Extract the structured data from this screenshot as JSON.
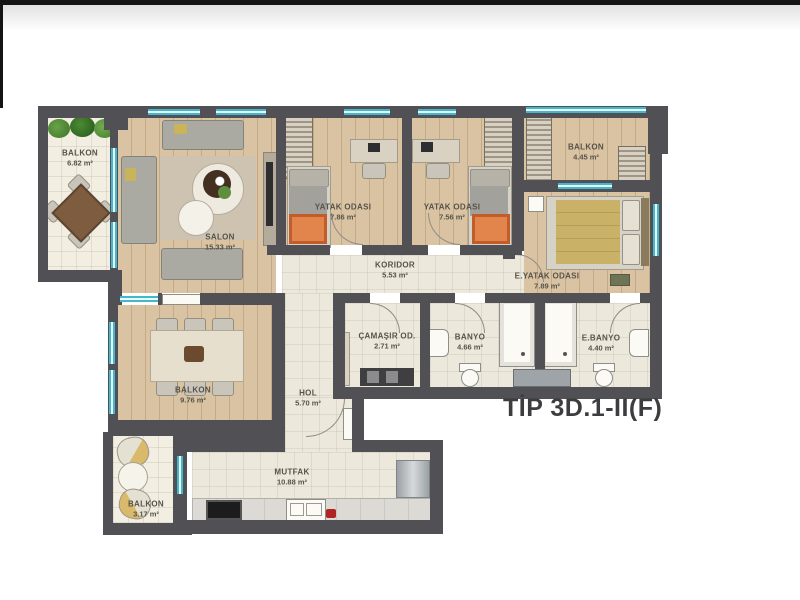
{
  "title": "TİP 3D.1-II(F)",
  "rooms": {
    "balkon_tl": {
      "label": "BALKON",
      "area": "6.82 m²"
    },
    "salon": {
      "label": "SALON",
      "area": "15.33 m²"
    },
    "yatak1": {
      "label": "YATAK ODASI",
      "area": "7.86 m²"
    },
    "yatak2": {
      "label": "YATAK ODASI",
      "area": "7.56 m²"
    },
    "balkon_tr": {
      "label": "BALKON",
      "area": "4.45 m²"
    },
    "eyatak": {
      "label": "E.YATAK ODASI",
      "area": "7.89 m²"
    },
    "koridor": {
      "label": "KORIDOR",
      "area": "5.53 m²"
    },
    "camasir": {
      "label": "ÇAMAŞIR OD.",
      "area": "2.71 m²"
    },
    "banyo": {
      "label": "BANYO",
      "area": "4.66 m²"
    },
    "ebanyo": {
      "label": "E.BANYO",
      "area": "4.40 m²"
    },
    "balkon_l": {
      "label": "BALKON",
      "area": "9.76 m²"
    },
    "hol": {
      "label": "HOL",
      "area": "5.70 m²"
    },
    "mutfak": {
      "label": "MUTFAK",
      "area": "10.88 m²"
    },
    "balkon_bl": {
      "label": "BALKON",
      "area": "3.17 m²"
    }
  },
  "colors": {
    "wall": "#515155",
    "window": "#45b7cb",
    "wood_floor": "#d9c3a3",
    "tile_floor": "#ece8db",
    "accent_orange": "#d96f35",
    "bed_yellow": "#c9b267",
    "plant_green": "#4c8a33",
    "title_text": "#3d3d40"
  }
}
